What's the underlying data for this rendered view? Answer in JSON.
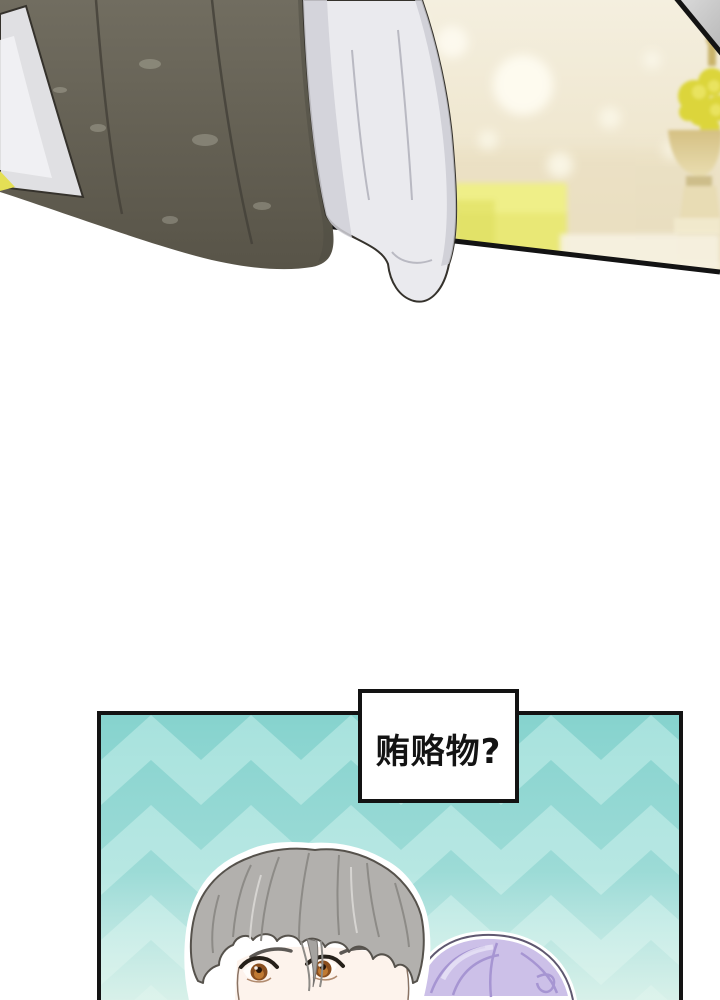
{
  "page": {
    "kind": "webtoon comic page"
  },
  "panels": {
    "top": {
      "description": "close-up of dark vest and white shirt sleeve, blurred banquet background with golden urn and yellow flowers"
    },
    "bottom": {
      "caption": "贿赂物?",
      "description": "gray-haired character and purple-haired character in front of teal chevron background"
    }
  },
  "colors": {
    "page_bg": "#ffffff",
    "ink": "#131313",
    "cream_top": "#f4efdf",
    "cream_bottom": "#ebdfc0",
    "vest_top": "#716d60",
    "vest_bottom": "#585448",
    "vest_seam": "#45423a",
    "sleeve": "#eaeaee",
    "sleeve_shadow": "#d0d0d7",
    "sleeve_ink": "#35322c",
    "left_sleeve": "#e0e0e3",
    "corner_gray": "#cfcfcf",
    "yellow_box": "#e9e876",
    "wedge_yellow": "#e4df55",
    "gold": "#d5c083",
    "gold_light": "#e9ddb0",
    "flower": "#dcd53b",
    "teal_base": "#86d3ce",
    "teal_light": "#a7e2dd",
    "hair_gray": "#b2b0ad",
    "hair_ink": "#56524c",
    "strand": "#8d8b87",
    "skin": "#fdf3ec",
    "brow": "#5d5955",
    "eye_dark": "#262019",
    "iris": "#8a4e1e",
    "iris_light": "#c07a33",
    "hair_purple": "#ccc0e8",
    "purple_strand": "#a695d2",
    "purple_ink": "#5f5870",
    "box_bg": "#ffffff"
  }
}
